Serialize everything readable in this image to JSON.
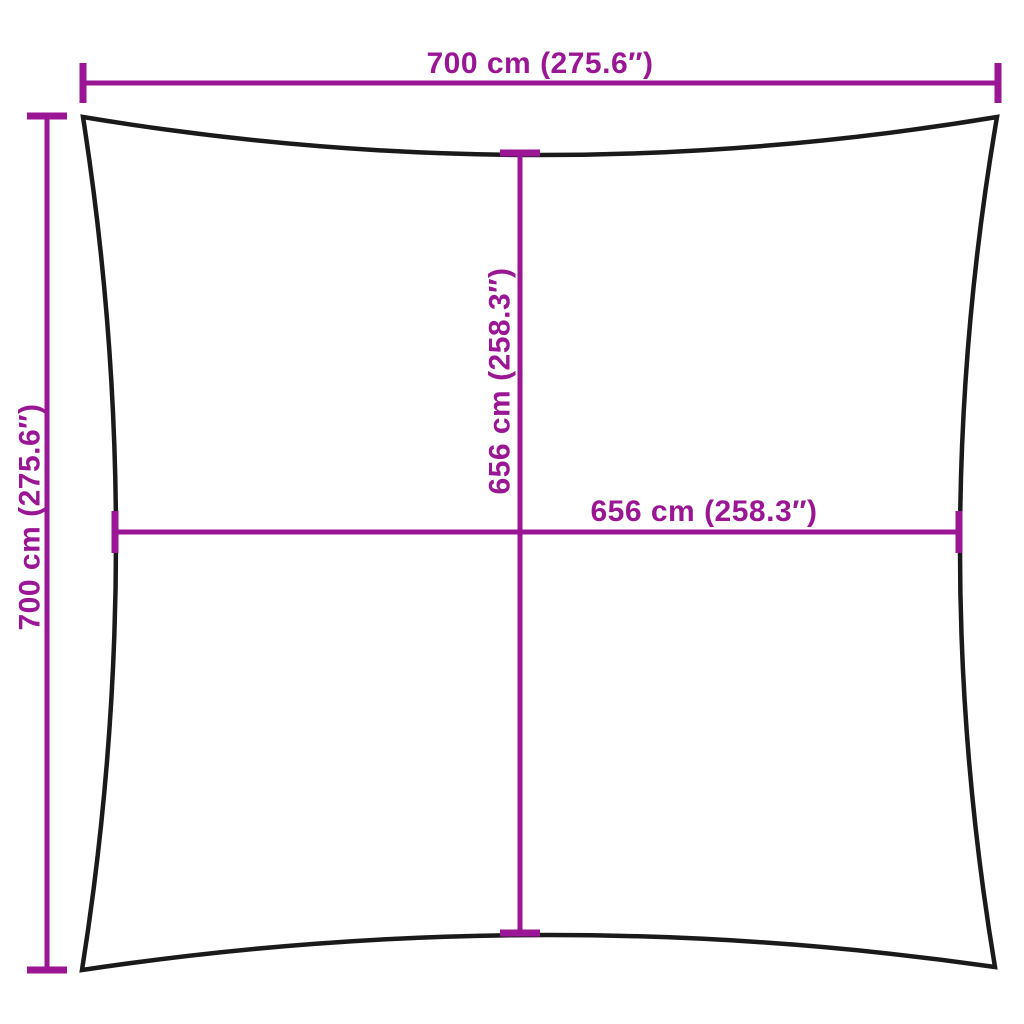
{
  "diagram": {
    "type": "product-dimension-diagram",
    "shape": "square shade sail with concave edges",
    "labels": {
      "top_width": "700 cm (275.6″)",
      "left_height": "700 cm (275.6″)",
      "inner_height": "656 cm (258.3″)",
      "inner_width": "656 cm (258.3″)"
    },
    "colors": {
      "dimension_accent": "#9a1694",
      "outline": "#1a1a1a",
      "background": "#ffffff"
    }
  }
}
